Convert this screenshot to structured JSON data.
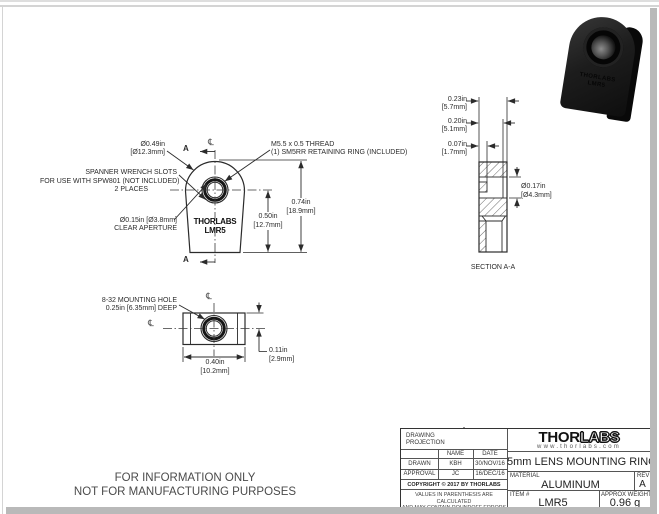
{
  "front_view": {
    "labels": {
      "diameter": {
        "line1": "Ø0.49in",
        "line2": "[Ø12.3mm]"
      },
      "thread": {
        "line1": "M5.5 x 0.5 THREAD",
        "line2": "(1) SM5RR RETAINING RING (INCLUDED)"
      },
      "spanner": {
        "line1": "SPANNER WRENCH SLOTS",
        "line2": "FOR USE WITH SPW801 (NOT INCLUDED)",
        "line3": "2 PLACES"
      },
      "aperture": {
        "line1": "Ø0.15in [Ø3.8mm]",
        "line2": "CLEAR APERTURE"
      }
    },
    "dims": {
      "height": {
        "in": "0.74in",
        "mm": "[18.9mm]"
      },
      "center": {
        "in": "0.50in",
        "mm": "[12.7mm]"
      }
    },
    "section_mark": "A",
    "centerline_symbol": "℄",
    "engraving": {
      "line1": "THORLABS",
      "line2": "LMR5"
    }
  },
  "section_view": {
    "dims": {
      "d1": {
        "in": "0.23in",
        "mm": "[5.7mm]"
      },
      "d2": {
        "in": "0.20in",
        "mm": "[5.1mm]"
      },
      "d3": {
        "in": "0.07in",
        "mm": "[1.7mm]"
      },
      "bore": {
        "in": "Ø0.17in",
        "mm": "[Ø4.3mm]"
      }
    },
    "caption": "SECTION A-A"
  },
  "bottom_view": {
    "labels": {
      "hole": {
        "line1": "8-32 MOUNTING HOLE",
        "line2": "0.25in [6.35mm] DEEP"
      }
    },
    "dims": {
      "offset": {
        "in": "0.11in",
        "mm": "[2.9mm]"
      },
      "width": {
        "in": "0.40in",
        "mm": "[10.2mm]"
      }
    },
    "centerline_symbol": "℄"
  },
  "footer": {
    "line1": "FOR INFORMATION ONLY",
    "line2": "NOT FOR MANUFACTURING PURPOSES"
  },
  "title_block": {
    "projection_label_line1": "DRAWING",
    "projection_label_line2": "PROJECTION",
    "col_name": "NAME",
    "col_date": "DATE",
    "drawn_label": "DRAWN",
    "drawn_name": "KBH",
    "drawn_date": "30/NOV/16",
    "approval_label": "APPROVAL",
    "approval_name": "JC",
    "approval_date": "16/DEC/16",
    "copyright": "COPYRIGHT © 2017 BY THORLABS",
    "disclaimer_line1": "VALUES IN PARENTHESIS ARE CALCULATED",
    "disclaimer_line2": "AND MAY CONTAIN ROUNDOFF ERRORS",
    "logo_thor": "THOR",
    "logo_labs": "LABS",
    "logo_url": "www.thorlabs.com",
    "drawing_title": "5mm LENS MOUNTING RING",
    "material_label": "MATERIAL",
    "material": "ALUMINUM",
    "rev_label": "REV",
    "rev": "A",
    "item_label": "ITEM #",
    "item": "LMR5",
    "weight_label": "APPROX WEIGHT",
    "weight": "0.96 g"
  },
  "product_render": {
    "engraving_line1": "THORLABS",
    "engraving_line2": "LMR5"
  },
  "colors": {
    "line": "#2b2b2b",
    "text": "#2b2b2b",
    "page_bg": "#ffffff",
    "shadow": "#b9b9b9",
    "product_black": "#161616"
  }
}
